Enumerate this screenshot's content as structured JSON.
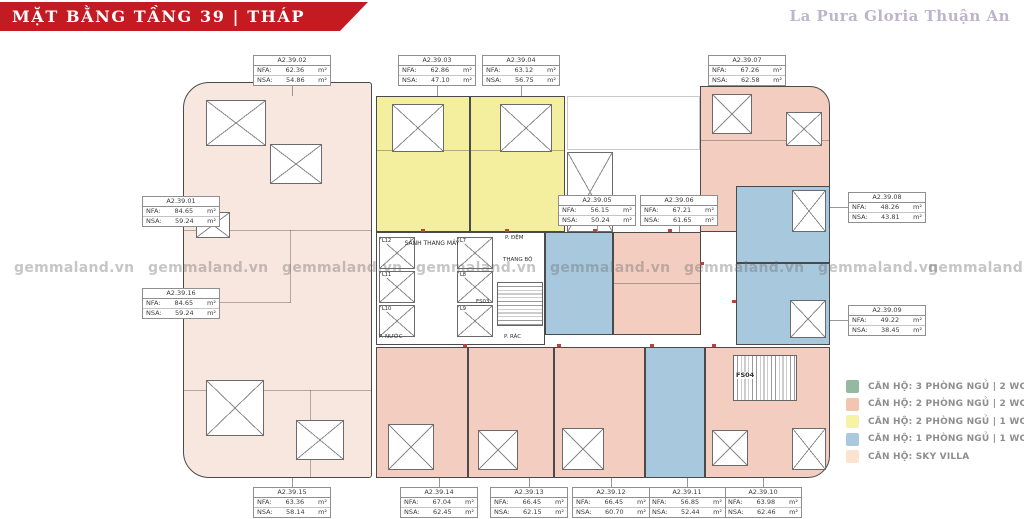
{
  "header": {
    "title": "MẶT BẰNG TẦNG 39 | THÁP GEMINI",
    "brand": "La Pura Gloria Thuận An"
  },
  "watermark": {
    "text": "gemmaland.vn"
  },
  "unit_fields": {
    "nfa_label": "NFA:",
    "nsa_label": "NSA:",
    "area_unit": "m²"
  },
  "units": [
    {
      "code": "A2.39.01",
      "nfa": "84.65",
      "nsa": "59.24"
    },
    {
      "code": "A2.39.02",
      "nfa": "62.36",
      "nsa": "54.86"
    },
    {
      "code": "A2.39.03",
      "nfa": "62.86",
      "nsa": "47.10"
    },
    {
      "code": "A2.39.04",
      "nfa": "63.12",
      "nsa": "56.75"
    },
    {
      "code": "A2.39.05",
      "nfa": "56.15",
      "nsa": "50.24"
    },
    {
      "code": "A2.39.06",
      "nfa": "67.21",
      "nsa": "61.65"
    },
    {
      "code": "A2.39.07",
      "nfa": "67.26",
      "nsa": "62.58"
    },
    {
      "code": "A2.39.08",
      "nfa": "48.26",
      "nsa": "43.81"
    },
    {
      "code": "A2.39.09",
      "nfa": "49.22",
      "nsa": "38.45"
    },
    {
      "code": "A2.39.10",
      "nfa": "63.98",
      "nsa": "62.46"
    },
    {
      "code": "A2.39.11",
      "nfa": "56.85",
      "nsa": "52.44"
    },
    {
      "code": "A2.39.12",
      "nfa": "66.45",
      "nsa": "60.70"
    },
    {
      "code": "A2.39.13",
      "nfa": "66.45",
      "nsa": "62.15"
    },
    {
      "code": "A2.39.14",
      "nfa": "67.04",
      "nsa": "62.45"
    },
    {
      "code": "A2.39.15",
      "nfa": "63.36",
      "nsa": "58.14"
    },
    {
      "code": "A2.39.16",
      "nfa": "84.65",
      "nsa": "59.24"
    }
  ],
  "core": {
    "lobby": "SẢNH THANG MÁY",
    "elevators": [
      "L12",
      "L11",
      "L10",
      "L7",
      "L8",
      "L9"
    ],
    "buffer_room": "P. ĐỆM",
    "stairwell": "THANG BỘ",
    "stair_a": "FS03",
    "stair_b": "FS04",
    "trash_room": "P. RÁC",
    "water_room": "P. NƯỚC"
  },
  "legend": {
    "items": [
      {
        "color": "#94b9a0",
        "label": "CĂN HỘ: 3 PHÒNG NGỦ | 2 WC"
      },
      {
        "color": "#f2c4b2",
        "label": "CĂN HỘ: 2 PHÒNG NGỦ | 2 WC"
      },
      {
        "color": "#f6f3a4",
        "label": "CĂN HỘ: 2 PHÒNG NGỦ | 1 WC"
      },
      {
        "color": "#a9cade",
        "label": "CĂN HỘ: 1 PHÒNG NGỦ | 1 WC"
      },
      {
        "color": "#fbe3d0",
        "label": "CĂN HỘ: SKY VILLA"
      }
    ]
  },
  "colors": {
    "banner_red": "#c41a22",
    "sky_villa_fill": "#f8e7de",
    "pink_2br2wc_fill": "#f3cec0",
    "yellow_2br1wc_fill": "#f3ef9f",
    "blue_1br1wc_fill": "#a8c9dd"
  }
}
